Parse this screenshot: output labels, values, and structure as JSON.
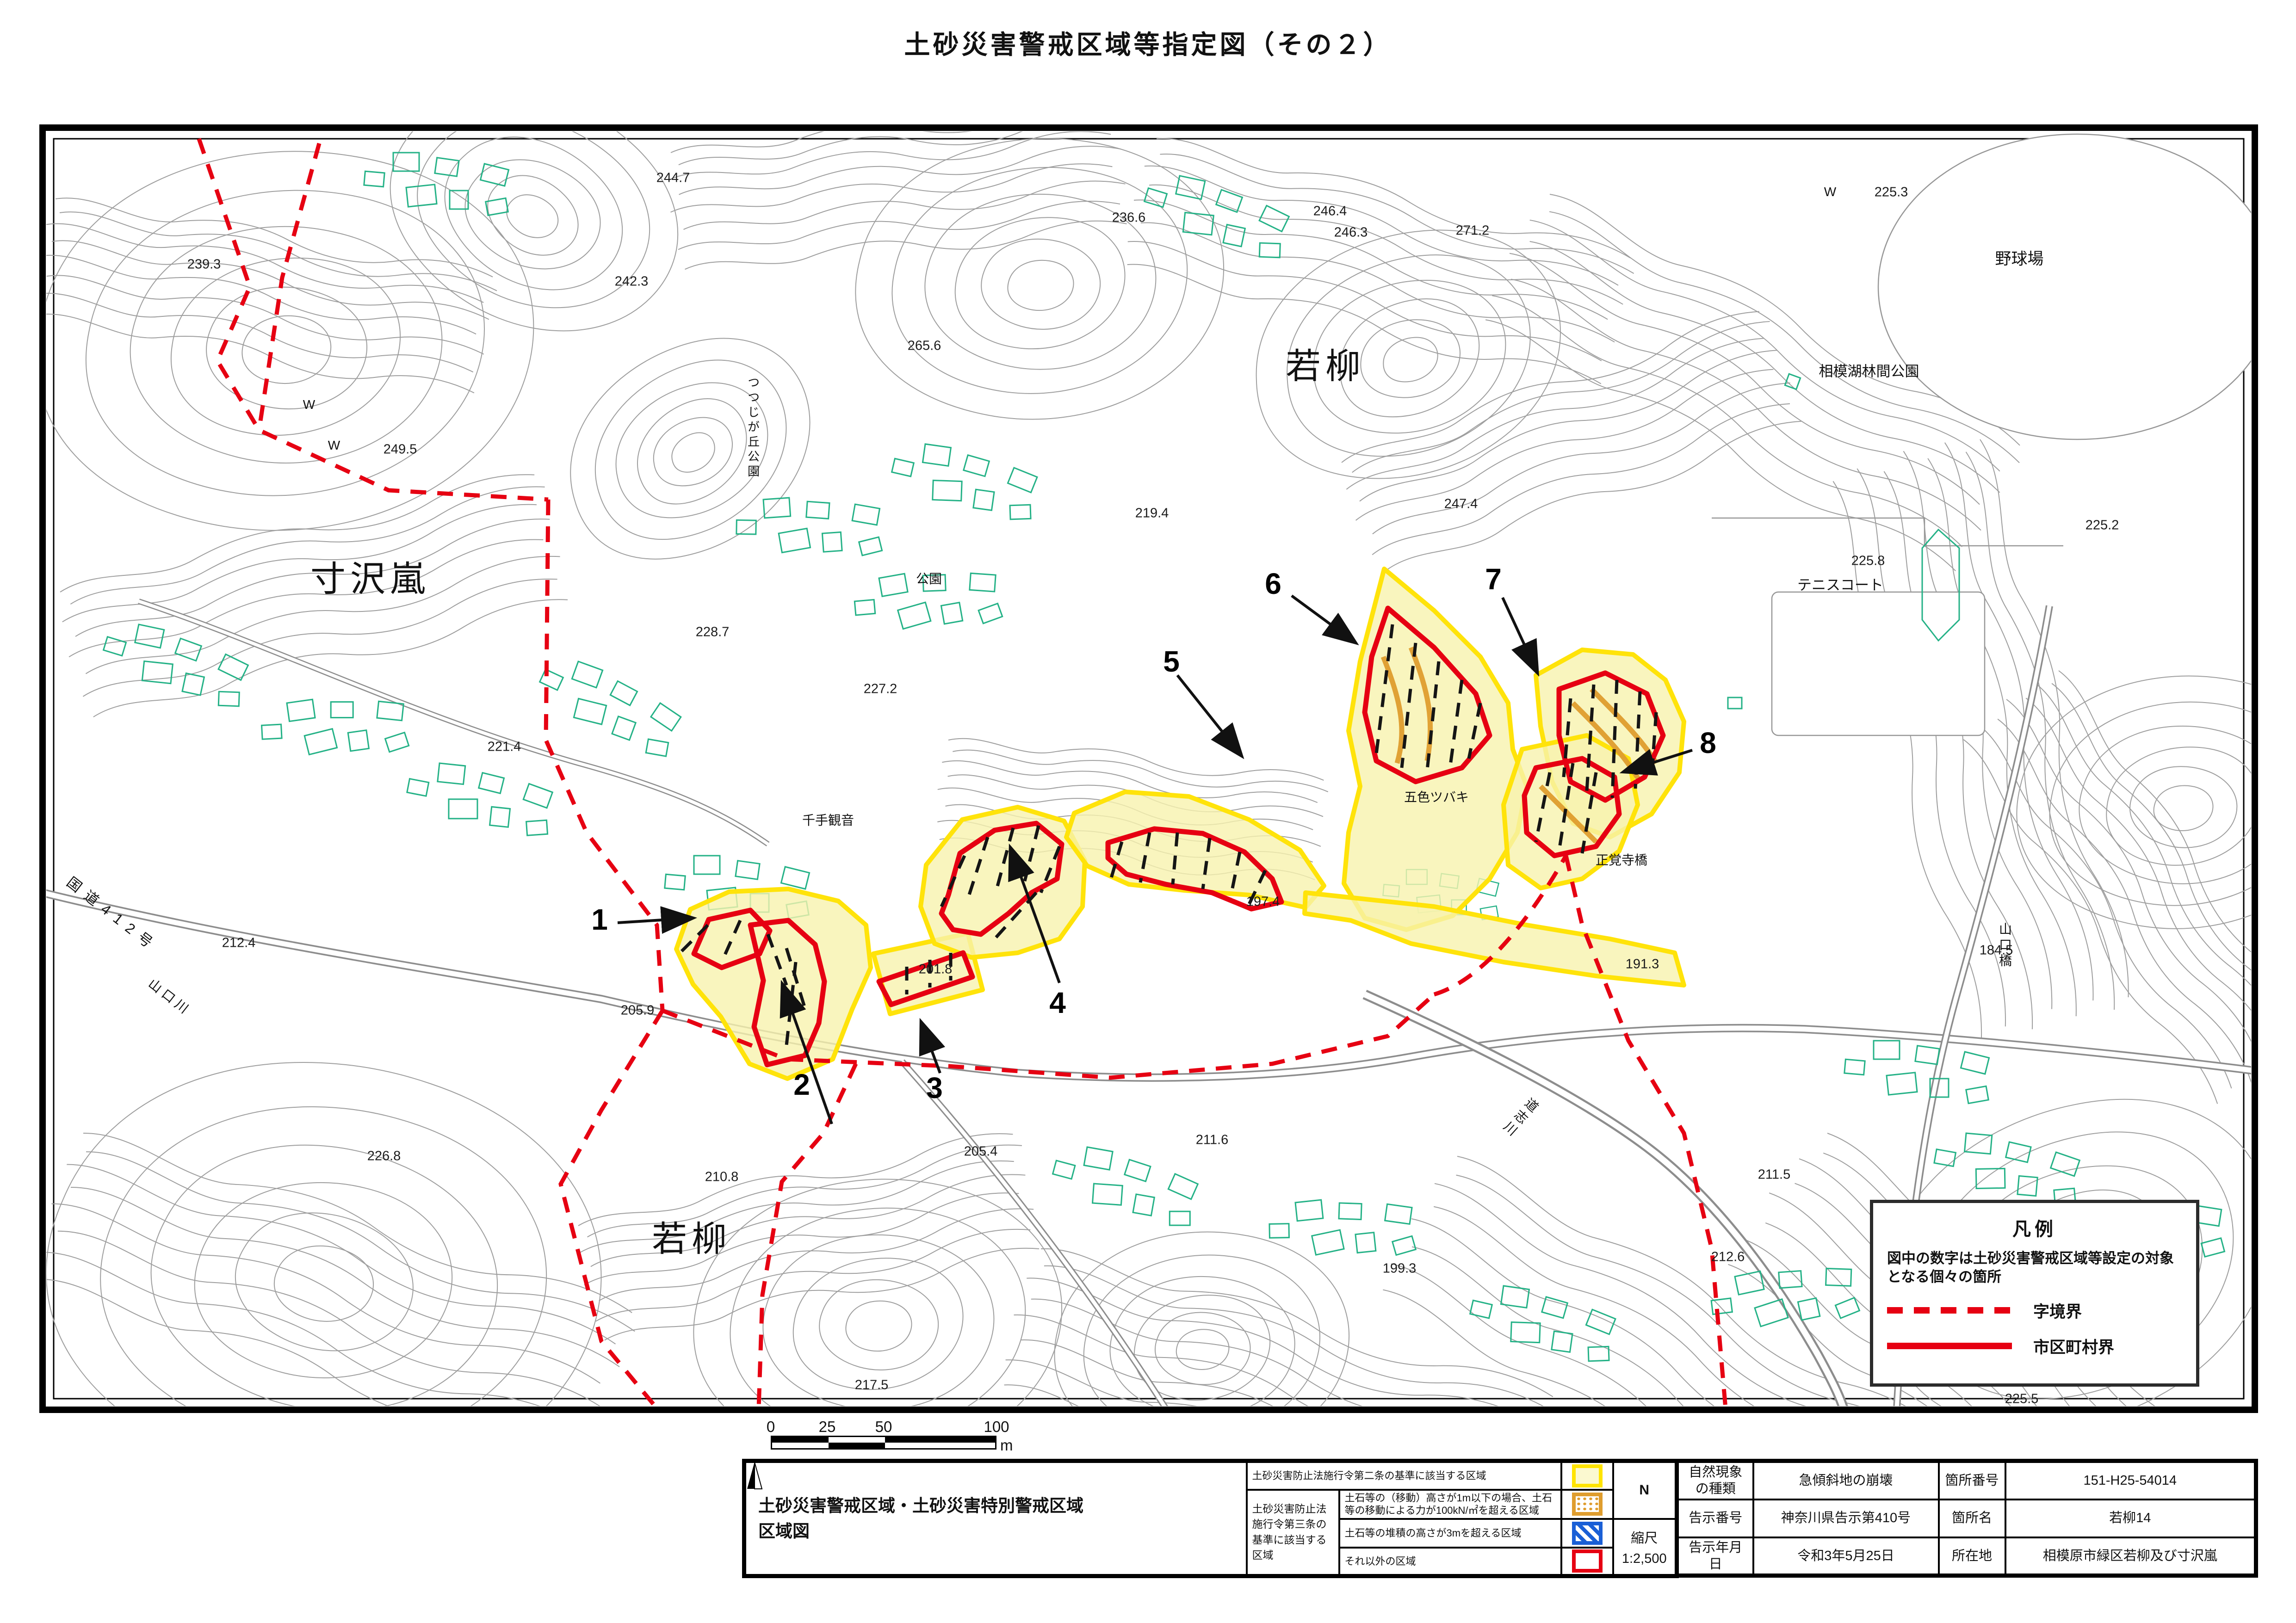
{
  "title": "土砂災害警戒区域等指定図（その２）",
  "colors": {
    "warning_yellow_border": "#ffe400",
    "warning_yellow_fill": "#f7f3ae",
    "special_red": "#e60012",
    "orange_zone": "#df9d2e",
    "blue_zone": "#1a5fd6",
    "building_green": "#25b287",
    "contour_gray": "#9e9e9e",
    "boundary_red_dashed": "#e60012"
  },
  "map": {
    "region_labels": {
      "sunzawarashi": "寸沢嵐",
      "wakayanagi_top": "若柳",
      "wakayanagi_bottom": "若柳"
    },
    "place_labels": {
      "yakyujo": "野球場",
      "rinkan_park": "相模湖林間公園",
      "tennis_court": "テニスコート",
      "tsutsujigaoka_park": "つつじが丘公園",
      "park": "公園",
      "senju_kannon": "千手観音",
      "goshiki_tsubaki": "五色ツバキ",
      "shogakuji_bridge": "正覚寺橋",
      "yamaguchi_bridge": "山口橋",
      "route412": "国道412号",
      "yamaguchi_river": "山口川",
      "doshi_river": "道志川",
      "w1": "W",
      "w2": "W",
      "w3": "W"
    },
    "site_numbers": [
      "1",
      "2",
      "3",
      "4",
      "5",
      "6",
      "7",
      "8"
    ],
    "elevations": [
      "239.3",
      "244.7",
      "242.3",
      "249.5",
      "236.6",
      "246.4",
      "246.3",
      "271.2",
      "265.6",
      "225.3",
      "225.2",
      "225.8",
      "219.4",
      "247.4",
      "228.7",
      "227.2",
      "221.4",
      "212.4",
      "205.9",
      "201.8",
      "197.4",
      "205.4",
      "226.8",
      "210.8",
      "211.6",
      "191.3",
      "184.5",
      "199.3",
      "211.5",
      "212.6",
      "217.5",
      "225.5"
    ]
  },
  "legend": {
    "title": "凡例",
    "note": "図中の数字は土砂災害警戒区域等設定の対象となる個々の箇所",
    "dashed_label": "字境界",
    "solid_label": "市区町村界"
  },
  "scalebar": {
    "ticks": [
      "0",
      "25",
      "50",
      "100"
    ],
    "unit": "m"
  },
  "info": {
    "map_title_line1": "土砂災害警戒区域・土砂災害特別警戒区域",
    "map_title_line2": "区域図",
    "criteria_row1": "土砂災害防止法施行令第二条の基準に該当する区域",
    "criteria_group": "土砂災害防止法施行令第三条の基準に該当する区域",
    "criteria_sub1": "土石等の（移動）高さが1m以下の場合、土石等の移動による力が100kN/㎡を超える区域",
    "criteria_sub2": "土石等の堆積の高さが3mを超える区域",
    "criteria_sub3": "それ以外の区域",
    "north": "N",
    "scale_label": "縮尺",
    "scale_value": "1:2,500",
    "rows": [
      [
        "自然現象の種類",
        "急傾斜地の崩壊",
        "箇所番号",
        "151-H25-54014"
      ],
      [
        "告示番号",
        "神奈川県告示第410号",
        "箇所名",
        "若柳14"
      ],
      [
        "告示年月日",
        "令和3年5月25日",
        "所在地",
        "相模原市緑区若柳及び寸沢嵐"
      ]
    ]
  }
}
